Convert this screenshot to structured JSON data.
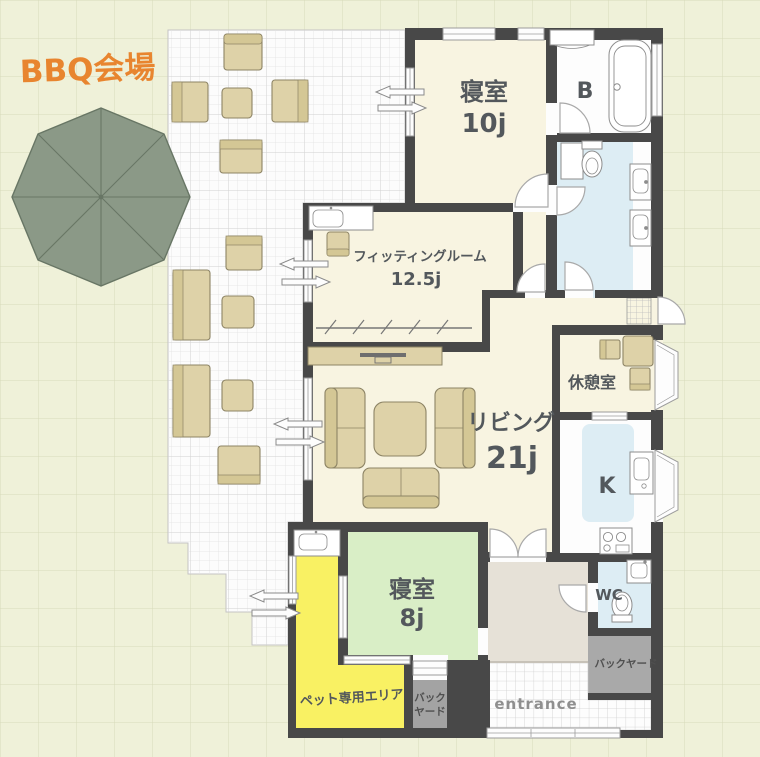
{
  "title": "戸建て間取り図（BBQ会場付き）",
  "labels": {
    "bbq": "BBQ会場",
    "bedroom10_name": "寝室",
    "bedroom10_size": "10j",
    "bath": "B",
    "fitting_name": "フィッティングルーム",
    "fitting_size": "12.5j",
    "rest": "休憩室",
    "living_name": "リビング",
    "living_size": "21j",
    "kitchen": "K",
    "bedroom8_name": "寝室",
    "bedroom8_size": "8j",
    "wc": "WC",
    "backyard": "バックヤード",
    "backyard_small_1": "バック",
    "backyard_small_2": "ヤード",
    "pet_area": "ペット専用エリア",
    "entrance": "entrance"
  },
  "colors": {
    "accent_orange": "#e8852f",
    "wall": "#484848",
    "background_cream": "#eff1d9",
    "floor_ivory": "#f8f4e1",
    "floor_green": "#d9eec6",
    "floor_yellow": "#f9f163",
    "floor_blue": "#ddedf4",
    "floor_white": "#fdfdfd",
    "floor_hall_beige": "#e6e1d7",
    "backyard_gray": "#a9a9a9",
    "furniture_tan": "#ded2a8",
    "umbrella_green": "#8b9987"
  }
}
